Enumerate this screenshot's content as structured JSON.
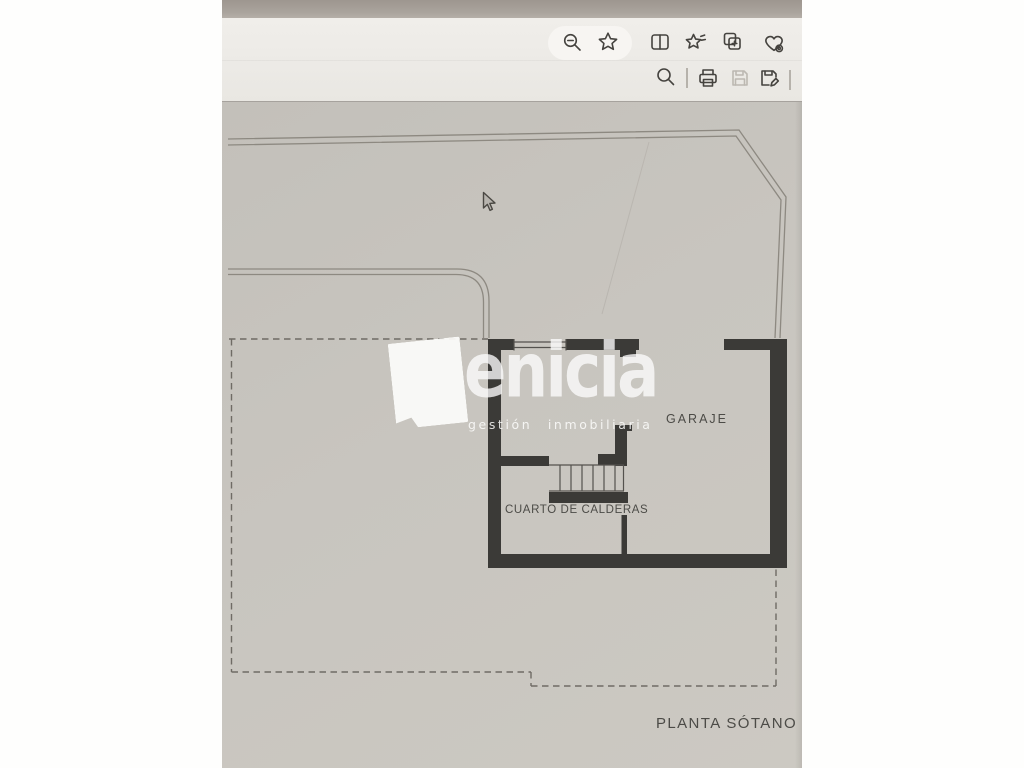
{
  "browser_toolbar": {
    "icons_row1": [
      {
        "name": "zoom-out"
      },
      {
        "name": "favorites-star"
      },
      {
        "name": "split-screen"
      },
      {
        "name": "collections"
      },
      {
        "name": "web-capture"
      },
      {
        "name": "browser-essentials"
      }
    ],
    "icons_row2": [
      {
        "name": "find-in-document"
      },
      {
        "name": "print"
      },
      {
        "name": "save"
      },
      {
        "name": "save-as"
      }
    ]
  },
  "document": {
    "labels": {
      "garage": "GARAJE",
      "boiler_room": "CUARTO DE CALDERAS"
    },
    "sheet_title": "PLANTA SÓTANO",
    "watermark": {
      "brand": "enicia",
      "tagline": "gestión inmobiliaria"
    }
  },
  "colors": {
    "page_gray": "#c8c5bf",
    "wall_dark": "#3b3a37",
    "toolbar_bg": "#eceae6",
    "top_edge_band": "#a59f98",
    "boundary_line": "#8d8981",
    "dashed_line": "#6f6b65",
    "watermark_white": "rgba(253,253,252,0.8)"
  }
}
